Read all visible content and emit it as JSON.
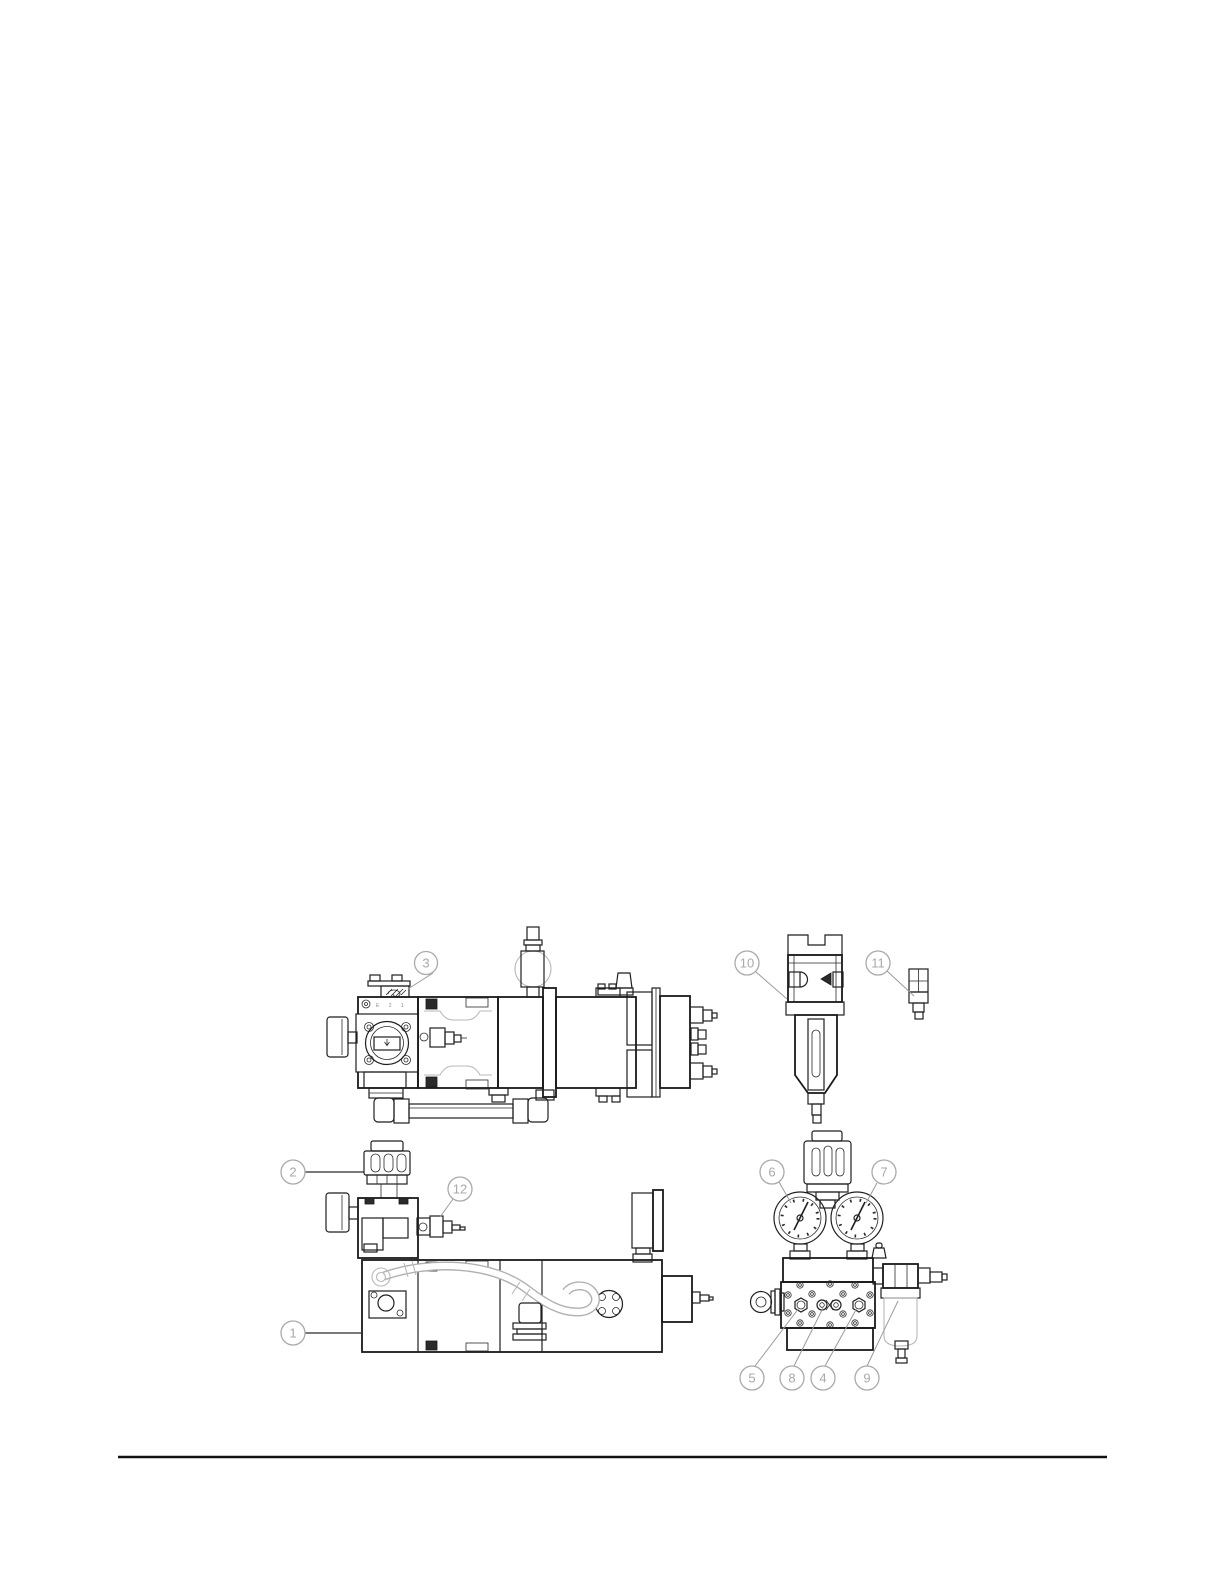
{
  "page": {
    "background_color": "#ffffff"
  },
  "diagram": {
    "kind": "technical-parts-line-drawing",
    "line_color": "#1f1f1f",
    "ghost_line_color": "#b8b8b8",
    "callout_color": "#a9a9a9",
    "port_labels": "E 2 1",
    "callouts": [
      {
        "label": "1"
      },
      {
        "label": "2"
      },
      {
        "label": "3"
      },
      {
        "label": "4"
      },
      {
        "label": "5"
      },
      {
        "label": "6"
      },
      {
        "label": "7"
      },
      {
        "label": "8"
      },
      {
        "label": "9"
      },
      {
        "label": "10"
      },
      {
        "label": "11"
      },
      {
        "label": "12"
      }
    ]
  },
  "footer": {
    "divider": true
  }
}
